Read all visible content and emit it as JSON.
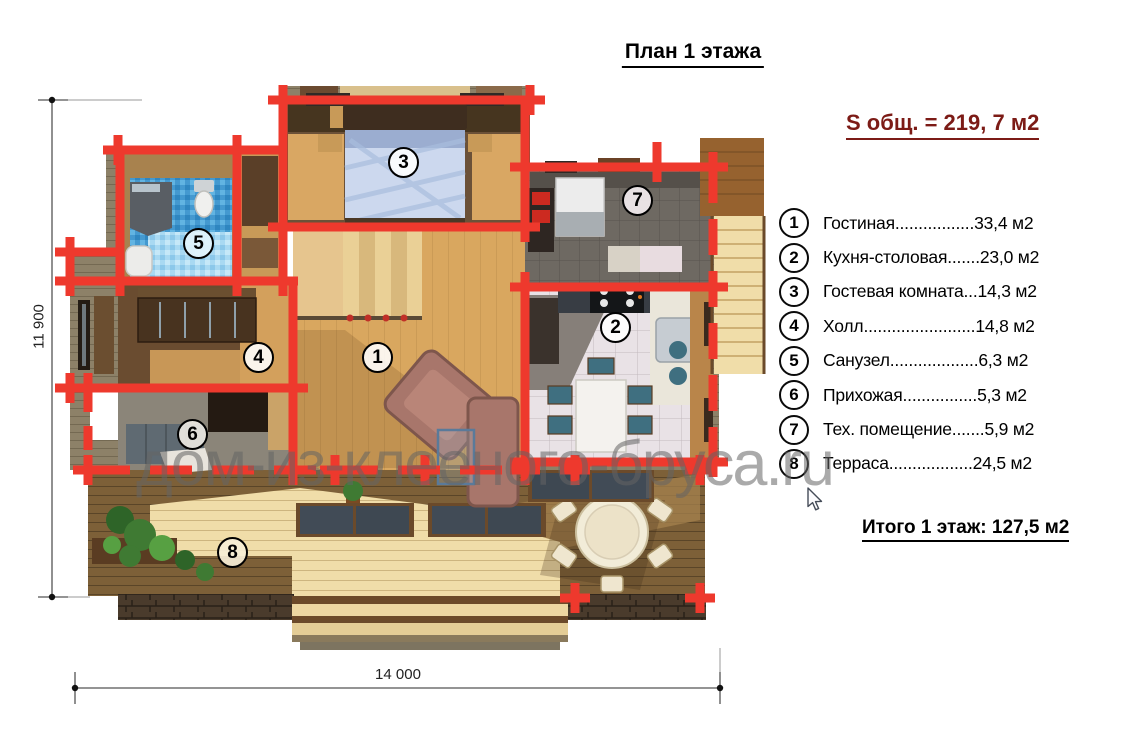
{
  "title": "План 1 этажа",
  "summary": {
    "total_area_label": "S общ. = 219, 7 м2",
    "floor_total_label": "Итого 1 этаж:  127,5 м2"
  },
  "legend": {
    "items": [
      {
        "number": "1",
        "text": "Гостиная.................33,4 м2"
      },
      {
        "number": "2",
        "text": "Кухня-столовая.......23,0 м2"
      },
      {
        "number": "3",
        "text": "Гостевая комната...14,3 м2"
      },
      {
        "number": "4",
        "text": "Холл........................14,8 м2"
      },
      {
        "number": "5",
        "text": "Санузел...................6,3 м2"
      },
      {
        "number": "6",
        "text": "Прихожая................5,3 м2"
      },
      {
        "number": "7",
        "text": "Тех. помещение.......5,9 м2"
      },
      {
        "number": "8",
        "text": "Терраса..................24,5 м2"
      }
    ]
  },
  "plan": {
    "markers": [
      "1",
      "2",
      "3",
      "4",
      "5",
      "6",
      "7",
      "8"
    ],
    "dimensions": {
      "height": "11 900",
      "width": "14 000"
    }
  },
  "watermark": {
    "text": "дом-из-клееного-бруса.ru"
  },
  "colors": {
    "wall_red": "#ee392d",
    "maroon_text": "#7c1b16",
    "watermark_gray": "#646464"
  }
}
